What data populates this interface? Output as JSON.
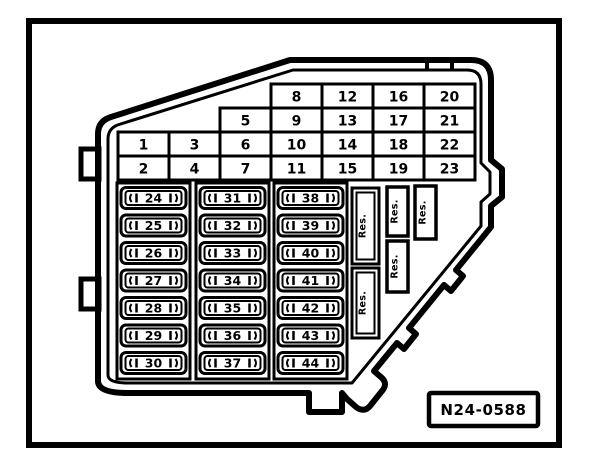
{
  "colors": {
    "ink": "#000000",
    "paper": "#ffffff"
  },
  "figure": {
    "code_label": "N24-0588"
  },
  "relay_grid": {
    "rows": [
      {
        "cells": [
          "8",
          "12",
          "16",
          "20"
        ]
      },
      {
        "cells": [
          "5",
          "9",
          "13",
          "17",
          "21"
        ]
      },
      {
        "cells": [
          "1",
          "3",
          "6",
          "10",
          "14",
          "18",
          "22"
        ]
      },
      {
        "cells": [
          "2",
          "4",
          "7",
          "11",
          "15",
          "19",
          "23"
        ]
      }
    ]
  },
  "fuse_block": {
    "columns": [
      {
        "slots": [
          "24",
          "25",
          "26",
          "27",
          "28",
          "29",
          "30"
        ]
      },
      {
        "slots": [
          "31",
          "32",
          "33",
          "34",
          "35",
          "36",
          "37"
        ]
      },
      {
        "slots": [
          "38",
          "39",
          "40",
          "41",
          "42",
          "43",
          "44"
        ]
      }
    ]
  },
  "reserve_slots": {
    "labels": [
      "Res.",
      "Res.",
      "Res.",
      "Res.",
      "Res."
    ]
  }
}
